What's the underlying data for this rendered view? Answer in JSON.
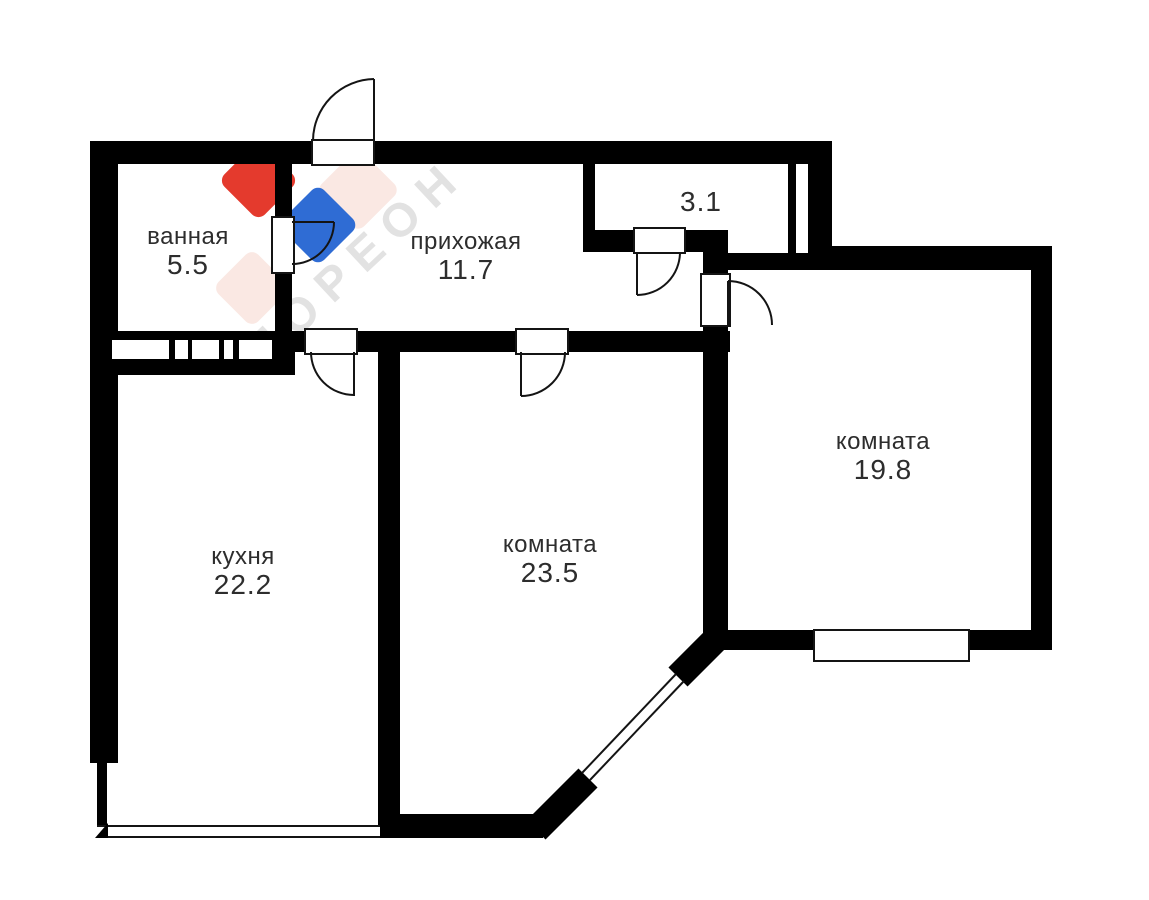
{
  "plan": {
    "title": "apartment floor plan",
    "rooms": [
      {
        "id": "bathroom",
        "name": "ванная",
        "area": "5.5"
      },
      {
        "id": "hallway",
        "name": "прихожая",
        "area": "11.7"
      },
      {
        "id": "closet",
        "name": "",
        "area": "3.1"
      },
      {
        "id": "kitchen",
        "name": "кухня",
        "area": "22.2"
      },
      {
        "id": "room-mid",
        "name": "комната",
        "area": "23.5"
      },
      {
        "id": "room-right",
        "name": "комната",
        "area": "19.8"
      }
    ],
    "watermark": {
      "text": "МОРЕОН",
      "colors": {
        "red": "#e43a2d",
        "blue": "#2f6cd4",
        "pale": "#fae8e3",
        "text": "#e2e2e2"
      }
    },
    "colors": {
      "wall": "#000000",
      "background": "#ffffff",
      "label": "#2d2d2d"
    }
  }
}
